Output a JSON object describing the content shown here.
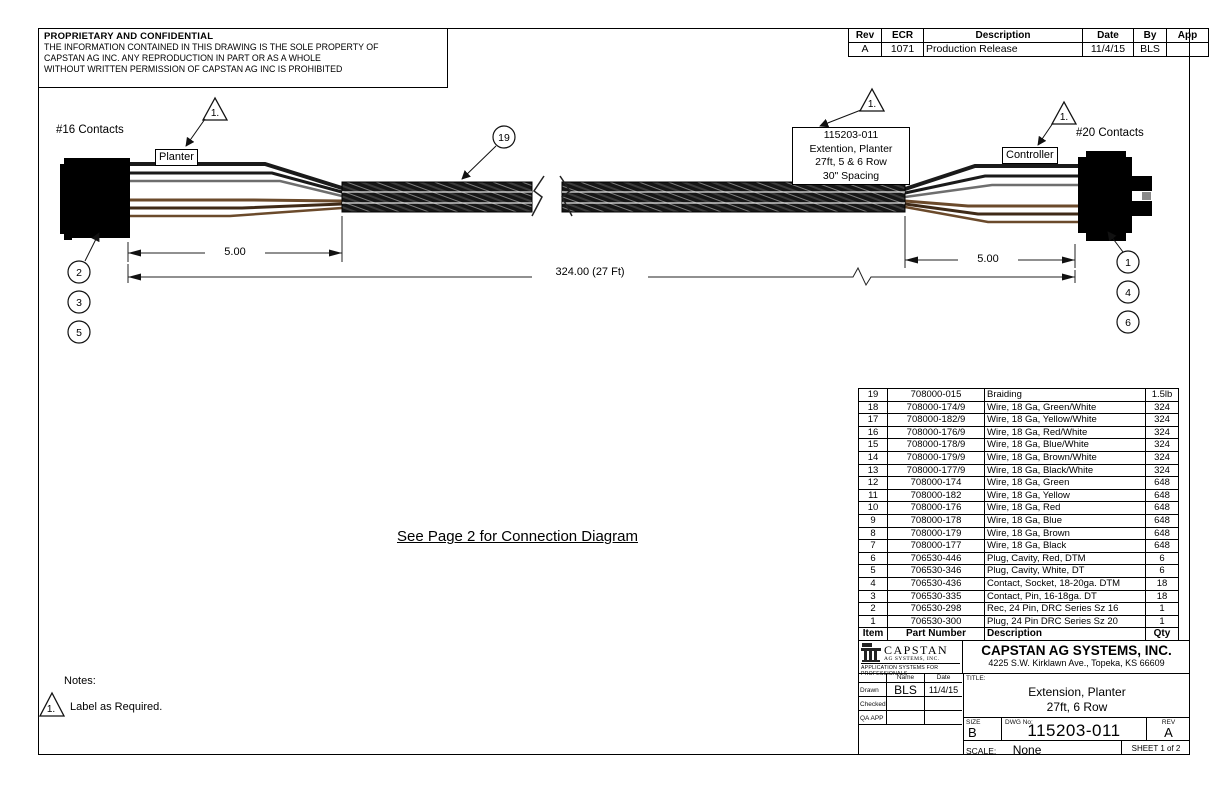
{
  "proprietary": {
    "title": "PROPRIETARY AND CONFIDENTIAL",
    "line1": "THE INFORMATION CONTAINED IN THIS DRAWING IS THE SOLE PROPERTY OF",
    "line2": "CAPSTAN AG INC. ANY REPRODUCTION IN PART OR AS A WHOLE",
    "line3": "WITHOUT WRITTEN PERMISSION OF CAPSTAN AG INC IS PROHIBITED"
  },
  "revision_table": {
    "headers": [
      "Rev",
      "ECR",
      "Description",
      "Date",
      "By",
      "App"
    ],
    "rows": [
      [
        "A",
        "1071",
        "Production Release",
        "11/4/15",
        "BLS",
        ""
      ]
    ]
  },
  "drawing": {
    "left_contacts": "#16 Contacts",
    "right_contacts": "#20 Contacts",
    "planter_tag": "Planter",
    "controller_tag": "Controller",
    "cable_tag_lines": [
      "115203-011",
      "Extention, Planter",
      "27ft, 5 & 6 Row",
      "30\" Spacing"
    ],
    "flag_note_number": "1.",
    "braid_balloon": "19",
    "left_balloons": [
      "2",
      "3",
      "5"
    ],
    "right_balloons": [
      "1",
      "4",
      "6"
    ],
    "dim_left": "5.00",
    "dim_right": "5.00",
    "dim_overall": "324.00 (27 Ft)"
  },
  "center_note": "See Page 2 for Connection Diagram",
  "bom": {
    "headers": [
      "Item",
      "Part Number",
      "Description",
      "Qty"
    ],
    "rows": [
      [
        "19",
        "708000-015",
        "Braiding",
        "1.5lb"
      ],
      [
        "18",
        "708000-174/9",
        "Wire, 18 Ga, Green/White",
        "324"
      ],
      [
        "17",
        "708000-182/9",
        "Wire, 18 Ga, Yellow/White",
        "324"
      ],
      [
        "16",
        "708000-176/9",
        "Wire, 18 Ga, Red/White",
        "324"
      ],
      [
        "15",
        "708000-178/9",
        "Wire, 18 Ga, Blue/White",
        "324"
      ],
      [
        "14",
        "708000-179/9",
        "Wire, 18 Ga, Brown/White",
        "324"
      ],
      [
        "13",
        "708000-177/9",
        "Wire, 18 Ga, Black/White",
        "324"
      ],
      [
        "12",
        "708000-174",
        "Wire, 18 Ga, Green",
        "648"
      ],
      [
        "11",
        "708000-182",
        "Wire, 18 Ga, Yellow",
        "648"
      ],
      [
        "10",
        "708000-176",
        "Wire, 18 Ga, Red",
        "648"
      ],
      [
        "9",
        "708000-178",
        "Wire, 18 Ga, Blue",
        "648"
      ],
      [
        "8",
        "708000-179",
        "Wire, 18 Ga, Brown",
        "648"
      ],
      [
        "7",
        "708000-177",
        "Wire, 18 Ga, Black",
        "648"
      ],
      [
        "6",
        "706530-446",
        "Plug, Cavity, Red, DTM",
        "6"
      ],
      [
        "5",
        "706530-346",
        "Plug, Cavity, White, DT",
        "6"
      ],
      [
        "4",
        "706530-436",
        "Contact, Socket, 18-20ga. DTM",
        "18"
      ],
      [
        "3",
        "706530-335",
        "Contact, Pin, 16-18ga. DT",
        "18"
      ],
      [
        "2",
        "706530-298",
        "Rec, 24 Pin, DRC Series Sz 16",
        "1"
      ],
      [
        "1",
        "706530-300",
        "Plug, 24 Pin DRC Series Sz 20",
        "1"
      ]
    ]
  },
  "notes": {
    "label": "Notes:",
    "note1_flag": "1.",
    "note1_text": "Label as Required."
  },
  "title_block": {
    "logo_name": "CAPSTAN",
    "logo_sub": "AG SYSTEMS, INC.",
    "logo_tagline": "APPLICATION SYSTEMS FOR PROFESSIONALS",
    "company": "CAPSTAN AG SYSTEMS, INC.",
    "address": "4225 S.W. Kirklawn Ave., Topeka, KS 66609",
    "name_header": "Name",
    "date_header": "Date",
    "drawn_label": "Drawn",
    "drawn_name": "BLS",
    "drawn_date": "11/4/15",
    "checked_label": "Checked",
    "qa_label": "QA APP",
    "title_label": "TITLE:",
    "title_line1": "Extension, Planter",
    "title_line2": "27ft, 6 Row",
    "size_label": "SIZE",
    "size_value": "B",
    "dwg_label": "DWG No:",
    "dwg_value": "115203-011",
    "rev_label": "REV",
    "rev_value": "A",
    "scale_label": "SCALE:",
    "scale_value": "None",
    "sheet_label": "SHEET 1 of 2"
  },
  "colors": {
    "wire_black": "#1a1a1a",
    "wire_gray": "#6e6e6e",
    "wire_brown": "#6b4a2b",
    "wire_dark_brown": "#3f2a17",
    "line": "#222222"
  }
}
